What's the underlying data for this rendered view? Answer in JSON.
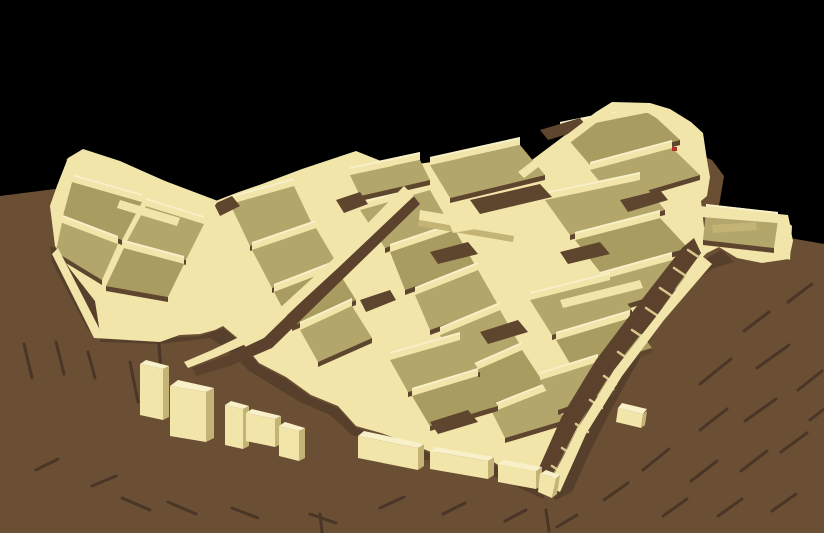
{
  "scene": {
    "label": "3D reconstruction model of an ancient walled settlement on a brown mound, viewed from above against a black background",
    "canvas": {
      "width": 824,
      "height": 533
    },
    "colors": {
      "background": "#000000",
      "terrain": "#6B4F34",
      "terrainShadow": "#57402B",
      "streak": "#4A3626",
      "street": "#5C422C",
      "alley": "#5E452E",
      "floor": "#B2A66B",
      "floorAlt": "#A89C61",
      "wall": "#F2E5AA",
      "wallTop": "#F7F0C8",
      "wallShade": "#D8C88C",
      "wallDark": "#C3B375",
      "marker": "#B23327"
    },
    "terrain": {
      "points": "0,196 55,189 120,205 200,215 280,228 360,240 440,256 520,266 580,270 630,258 668,230 685,195 697,163 703,156 712,160 724,176 720,200 716,222 735,228 765,231 790,238 824,244 824,533 0,533"
    },
    "terrainShadows": [
      {
        "points": "100,336 160,338 200,336 223,328 241,343 259,365 286,379 311,397 338,408 356,428 381,435 409,445 431,454 463,454 489,461 506,472 530,478 549,486 543,499 505,481 460,462 425,460 395,450 352,435 330,415 300,402 272,385 248,370 228,350 210,338 160,344 100,342"
      },
      {
        "points": "561,462 580,428 602,388 627,348 652,318 678,290 698,266 710,256 722,250 734,262 714,268 696,280 676,302 654,334 632,372 610,412 590,452 572,492 556,500 546,492"
      },
      {
        "points": "50,246 62,250 95,302 100,334 88,330 72,300 52,262"
      }
    ],
    "streaks": [
      [
        24,
        344,
        32,
        378
      ],
      [
        56,
        342,
        64,
        374
      ],
      [
        88,
        352,
        95,
        378
      ],
      [
        130,
        362,
        138,
        402
      ],
      [
        158,
        332,
        163,
        398
      ],
      [
        122,
        498,
        150,
        510
      ],
      [
        168,
        502,
        196,
        514
      ],
      [
        232,
        508,
        258,
        518
      ],
      [
        310,
        514,
        336,
        523
      ],
      [
        320,
        514,
        322,
        532
      ],
      [
        380,
        508,
        404,
        497
      ],
      [
        443,
        514,
        465,
        503
      ],
      [
        505,
        521,
        526,
        510
      ],
      [
        546,
        510,
        549,
        531
      ],
      [
        557,
        527,
        577,
        515
      ],
      [
        700,
        384,
        731,
        359
      ],
      [
        744,
        331,
        769,
        312
      ],
      [
        757,
        368,
        789,
        345
      ],
      [
        700,
        430,
        727,
        409
      ],
      [
        745,
        421,
        776,
        399
      ],
      [
        788,
        302,
        812,
        284
      ],
      [
        798,
        390,
        822,
        371
      ],
      [
        643,
        470,
        669,
        449
      ],
      [
        691,
        481,
        717,
        461
      ],
      [
        741,
        471,
        767,
        451
      ],
      [
        781,
        452,
        807,
        433
      ],
      [
        604,
        500,
        628,
        483
      ],
      [
        663,
        516,
        687,
        499
      ],
      [
        718,
        516,
        742,
        499
      ],
      [
        772,
        511,
        796,
        494
      ],
      [
        810,
        420,
        824,
        409
      ],
      [
        36,
        470,
        58,
        459
      ],
      [
        92,
        486,
        116,
        476
      ]
    ],
    "mass": {
      "points": "68,158 83,149 120,161 165,181 213,202 236,193 262,184 302,169 356,151 376,159 396,167 432,162 458,155 472,166 488,171 520,169 596,112 612,102 650,103 670,109 691,122 703,133 707,160 710,177 707,196 701,201 704,227 724,213 750,209 776,217 790,226 793,241 789,259 762,263 737,258 719,247 707,253 696,263 676,288 651,316 626,346 601,386 579,426 561,459 549,484 530,476 506,470 489,459 463,452 431,452 409,443 381,433 356,426 338,406 311,395 286,377 259,363 241,341 223,326 215,330 200,334 160,336 120,336 100,333 95,301 70,269 55,246 50,206 57,186"
    },
    "floors": [
      [
        72,
        182,
        142,
        202,
        122,
        240,
        58,
        216
      ],
      [
        146,
        206,
        204,
        224,
        186,
        260,
        126,
        243
      ],
      [
        60,
        222,
        118,
        244,
        102,
        280,
        56,
        252
      ],
      [
        124,
        248,
        184,
        264,
        168,
        297,
        106,
        286
      ],
      [
        230,
        204,
        294,
        186,
        312,
        224,
        250,
        246
      ],
      [
        252,
        250,
        316,
        228,
        336,
        262,
        272,
        288
      ],
      [
        274,
        292,
        336,
        268,
        356,
        300,
        292,
        326
      ],
      [
        300,
        330,
        352,
        306,
        372,
        338,
        318,
        362
      ],
      [
        360,
        210,
        430,
        190,
        450,
        225,
        385,
        248
      ],
      [
        390,
        252,
        455,
        230,
        475,
        265,
        405,
        290
      ],
      [
        415,
        295,
        478,
        270,
        498,
        305,
        430,
        330
      ],
      [
        440,
        335,
        500,
        310,
        520,
        345,
        455,
        370
      ],
      [
        465,
        375,
        522,
        350,
        545,
        385,
        478,
        408
      ],
      [
        492,
        412,
        548,
        390,
        565,
        420,
        505,
        438
      ],
      [
        430,
        165,
        520,
        145,
        545,
        175,
        450,
        198
      ],
      [
        560,
        130,
        650,
        112,
        680,
        140,
        590,
        165
      ],
      [
        590,
        170,
        672,
        148,
        700,
        175,
        615,
        200
      ],
      [
        545,
        200,
        640,
        180,
        665,
        210,
        570,
        235
      ],
      [
        575,
        240,
        660,
        218,
        688,
        248,
        600,
        272
      ],
      [
        600,
        280,
        672,
        260,
        690,
        285,
        620,
        306
      ],
      [
        530,
        300,
        610,
        280,
        632,
        310,
        552,
        335
      ],
      [
        556,
        340,
        630,
        318,
        652,
        348,
        575,
        372
      ],
      [
        540,
        380,
        598,
        362,
        615,
        390,
        558,
        410
      ],
      [
        390,
        360,
        460,
        340,
        480,
        372,
        408,
        392
      ],
      [
        412,
        396,
        478,
        376,
        498,
        406,
        430,
        426
      ],
      [
        706,
        212,
        778,
        220,
        774,
        248,
        703,
        240
      ],
      [
        350,
        175,
        420,
        160,
        430,
        180,
        360,
        196
      ]
    ],
    "alleys": [
      {
        "points": "214,204 232,196 240,206 220,216"
      },
      {
        "points": "336,200 360,192 368,204 344,213"
      },
      {
        "points": "470,200 540,184 552,197 480,214"
      },
      {
        "points": "430,252 468,242 478,254 438,264"
      },
      {
        "points": "560,252 600,242 610,254 568,264"
      },
      {
        "points": "480,332 518,320 528,332 488,344"
      },
      {
        "points": "430,422 468,410 478,422 438,434"
      },
      {
        "points": "620,200 660,190 668,200 628,212"
      },
      {
        "points": "540,130 580,118 588,128 548,140"
      },
      {
        "points": "360,300 390,290 396,300 366,312"
      }
    ],
    "streets": [
      {
        "name": "street-main",
        "points": "412,194 420,204 346,276 272,348 230,366 196,376 192,368 226,356 264,338 336,268"
      },
      {
        "name": "street-stairs",
        "points": "694,238 701,253 658,312 614,368 578,426 549,482 538,470 562,416 596,360 640,302 682,248"
      }
    ],
    "steps": [
      [
        688,
        250,
        700,
        258
      ],
      [
        674,
        268,
        686,
        276
      ],
      [
        660,
        288,
        672,
        296
      ],
      [
        646,
        308,
        658,
        316
      ],
      [
        632,
        330,
        644,
        338
      ],
      [
        618,
        352,
        630,
        360
      ],
      [
        604,
        376,
        616,
        384
      ],
      [
        590,
        400,
        602,
        408
      ],
      [
        576,
        424,
        588,
        432
      ],
      [
        562,
        448,
        574,
        456
      ],
      [
        552,
        466,
        564,
        474
      ]
    ],
    "extraWalls": [
      {
        "name": "left-block-top-wall",
        "points": "66,160 83,150 218,201 212,210",
        "fill": "wall"
      },
      {
        "name": "left-block-west-wall",
        "points": "50,206 57,186 68,158 77,164 64,212 57,247",
        "fill": "wall"
      },
      {
        "name": "left-block-south-wall",
        "points": "58,248 100,330 160,334 214,312 216,322 160,342 94,338 52,254",
        "fill": "wall"
      },
      {
        "name": "street-side-wall",
        "points": "404,186 414,196 338,268 264,336 216,357 188,368 184,362 212,350 258,328 330,262",
        "fill": "wall"
      },
      {
        "name": "southeast-boundary-wall",
        "points": "548,486 578,428 614,370 658,314 701,255 712,264 664,320 622,376 586,434 560,492",
        "fill": "wall"
      },
      {
        "name": "northeast-block-rim-wall",
        "points": "596,114 612,104 650,105 690,124 701,134 696,142 648,113 613,112 600,121",
        "fill": "wall"
      },
      {
        "name": "central-diagonal-wall",
        "points": "518,172 594,114 600,120 524,178",
        "fill": "wall"
      },
      {
        "name": "central-long-wall",
        "points": "420,210 515,226 514,236 419,220",
        "fill": "wall"
      },
      {
        "name": "central-long-wall-shadow",
        "points": "419,220 514,236 513,242 418,226",
        "fill": "wallDark"
      },
      {
        "name": "east-wing-rim-wall",
        "points": "700,206 788,215 790,224 701,217",
        "fill": "wall"
      },
      {
        "name": "east-wing-end-wall",
        "points": "783,218 792,226 790,260 782,256",
        "fill": "wall"
      },
      {
        "name": "east-wing-inner-wall",
        "points": "712,225 756,222 757,230 713,233",
        "fill": "wallDark"
      },
      {
        "name": "upper-mid-wall",
        "points": "302,170 356,152 360,158 308,177",
        "fill": "wall"
      },
      {
        "name": "central-cross-wall",
        "points": "450,225 545,208 548,216 453,233",
        "fill": "wall"
      },
      {
        "name": "left-block-inner-wall",
        "points": "120,200 180,218 177,226 117,208",
        "fill": "wall"
      },
      {
        "name": "mid-right-wall",
        "points": "560,300 640,280 643,288 563,308",
        "fill": "wall"
      }
    ],
    "blocks": [
      {
        "face": "170,386 206,392 206,442 170,436",
        "side": "206,392 214,388 214,438 206,442",
        "top": "170,386 178,380 214,388 206,392"
      },
      {
        "face": "225,405 243,409 243,449 225,445",
        "side": "243,409 249,406 249,446 243,449",
        "top": "225,405 231,401 249,406 243,409"
      },
      {
        "face": "246,413 275,419 275,447 246,441",
        "side": "275,419 281,416 281,444 275,447",
        "top": "246,413 252,409 281,416 275,419"
      },
      {
        "face": "279,426 299,431 299,461 279,456",
        "side": "299,431 305,428 305,458 299,461",
        "top": "279,426 285,422 305,428 299,431"
      },
      {
        "face": "140,364 163,369 163,420 140,415",
        "side": "163,369 169,366 169,417 163,420",
        "top": "140,364 146,360 169,366 163,369"
      },
      {
        "face": "358,436 418,448 418,470 358,458",
        "side": "418,448 424,444 424,466 418,470",
        "top": "358,436 364,431 424,444 418,448"
      },
      {
        "face": "430,451 488,461 488,479 430,469",
        "side": "488,461 494,457 494,475 488,479",
        "top": "430,451 436,447 494,457 488,461"
      },
      {
        "face": "498,464 536,471 536,489 498,482",
        "side": "536,471 542,467 542,485 536,489",
        "top": "498,464 504,460 542,467 536,471"
      },
      {
        "face": "540,474 556,478 552,498 538,492",
        "side": "556,478 560,475 557,494 552,498",
        "top": "540,474 546,470 560,475 556,478"
      },
      {
        "face": "618,408 643,414 641,428 616,422",
        "side": "643,414 647,411 645,425 641,428",
        "top": "618,408 622,403 647,409 643,414"
      }
    ],
    "marker": {
      "x": 672,
      "y": 147,
      "w": 5,
      "h": 4
    }
  }
}
